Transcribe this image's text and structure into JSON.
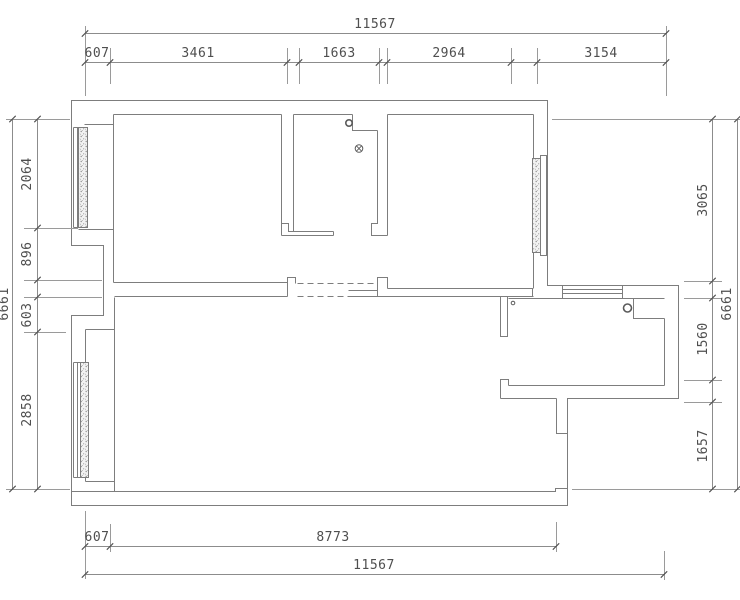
{
  "drawing": {
    "type": "apartment-floor-plan",
    "units": "mm",
    "background_color": "#ffffff",
    "wall_line_color": "#7d7d7d",
    "dimension_text_color": "#4f4f4f"
  },
  "dimensions": {
    "top": {
      "total": "11567",
      "chain": [
        "607",
        "3461",
        "1663",
        "2964",
        "3154"
      ]
    },
    "left": {
      "total": "6661",
      "chain": [
        "2064",
        "896",
        "603",
        "2858"
      ]
    },
    "right": {
      "total": "6661",
      "chain": [
        "3065",
        "1560",
        "1657"
      ]
    },
    "bottom": {
      "total": "11567",
      "chain": [
        "607",
        "8773"
      ]
    },
    "labels": [
      {
        "id": "top-total",
        "text": "11567",
        "x": 375,
        "y": 28,
        "rot": 0
      },
      {
        "id": "top-seg-1",
        "text": "607",
        "x": 97,
        "y": 57,
        "rot": 0
      },
      {
        "id": "top-seg-2",
        "text": "3461",
        "x": 198,
        "y": 57,
        "rot": 0
      },
      {
        "id": "top-seg-3",
        "text": "1663",
        "x": 339,
        "y": 57,
        "rot": 0
      },
      {
        "id": "top-seg-4",
        "text": "2964",
        "x": 449,
        "y": 57,
        "rot": 0
      },
      {
        "id": "top-seg-5",
        "text": "3154",
        "x": 601,
        "y": 57,
        "rot": 0
      },
      {
        "id": "left-total",
        "text": "6661",
        "x": 8,
        "y": 304,
        "rot": -90
      },
      {
        "id": "left-seg-1",
        "text": "2064",
        "x": 31,
        "y": 174,
        "rot": -90
      },
      {
        "id": "left-seg-2",
        "text": "896",
        "x": 31,
        "y": 254,
        "rot": -90
      },
      {
        "id": "left-seg-3",
        "text": "603",
        "x": 31,
        "y": 315,
        "rot": -90
      },
      {
        "id": "left-seg-4",
        "text": "2858",
        "x": 31,
        "y": 410,
        "rot": -90
      },
      {
        "id": "right-seg-1",
        "text": "3065",
        "x": 707,
        "y": 200,
        "rot": -90
      },
      {
        "id": "right-seg-2",
        "text": "1560",
        "x": 707,
        "y": 339,
        "rot": -90
      },
      {
        "id": "right-seg-3",
        "text": "1657",
        "x": 707,
        "y": 446,
        "rot": -90
      },
      {
        "id": "right-total",
        "text": "6661",
        "x": 731,
        "y": 304,
        "rot": -90
      },
      {
        "id": "bottom-seg-1",
        "text": "607",
        "x": 97,
        "y": 541,
        "rot": 0
      },
      {
        "id": "bottom-seg-2",
        "text": "8773",
        "x": 333,
        "y": 541,
        "rot": 0
      },
      {
        "id": "bottom-total",
        "text": "11567",
        "x": 374,
        "y": 569,
        "rot": 0
      }
    ]
  },
  "symbols": [
    {
      "name": "pipe-riser-icon",
      "kind": "ring",
      "x": 349,
      "y": 123,
      "r": 3.2
    },
    {
      "name": "floor-drain-icon",
      "kind": "crossed",
      "x": 359,
      "y": 148.5,
      "r": 3.8
    },
    {
      "name": "pipe-riser-icon",
      "kind": "ring",
      "x": 627.5,
      "y": 308,
      "r": 4
    },
    {
      "name": "small-pipe-icon",
      "kind": "dot",
      "x": 513,
      "y": 303,
      "r": 1.8
    }
  ],
  "windows": [
    {
      "name": "window-left-upper",
      "wall": "left"
    },
    {
      "name": "window-left-lower",
      "wall": "left"
    },
    {
      "name": "window-right-upper",
      "wall": "right"
    },
    {
      "name": "window-kitchen-top",
      "wall": "top-of-kitchen"
    }
  ]
}
